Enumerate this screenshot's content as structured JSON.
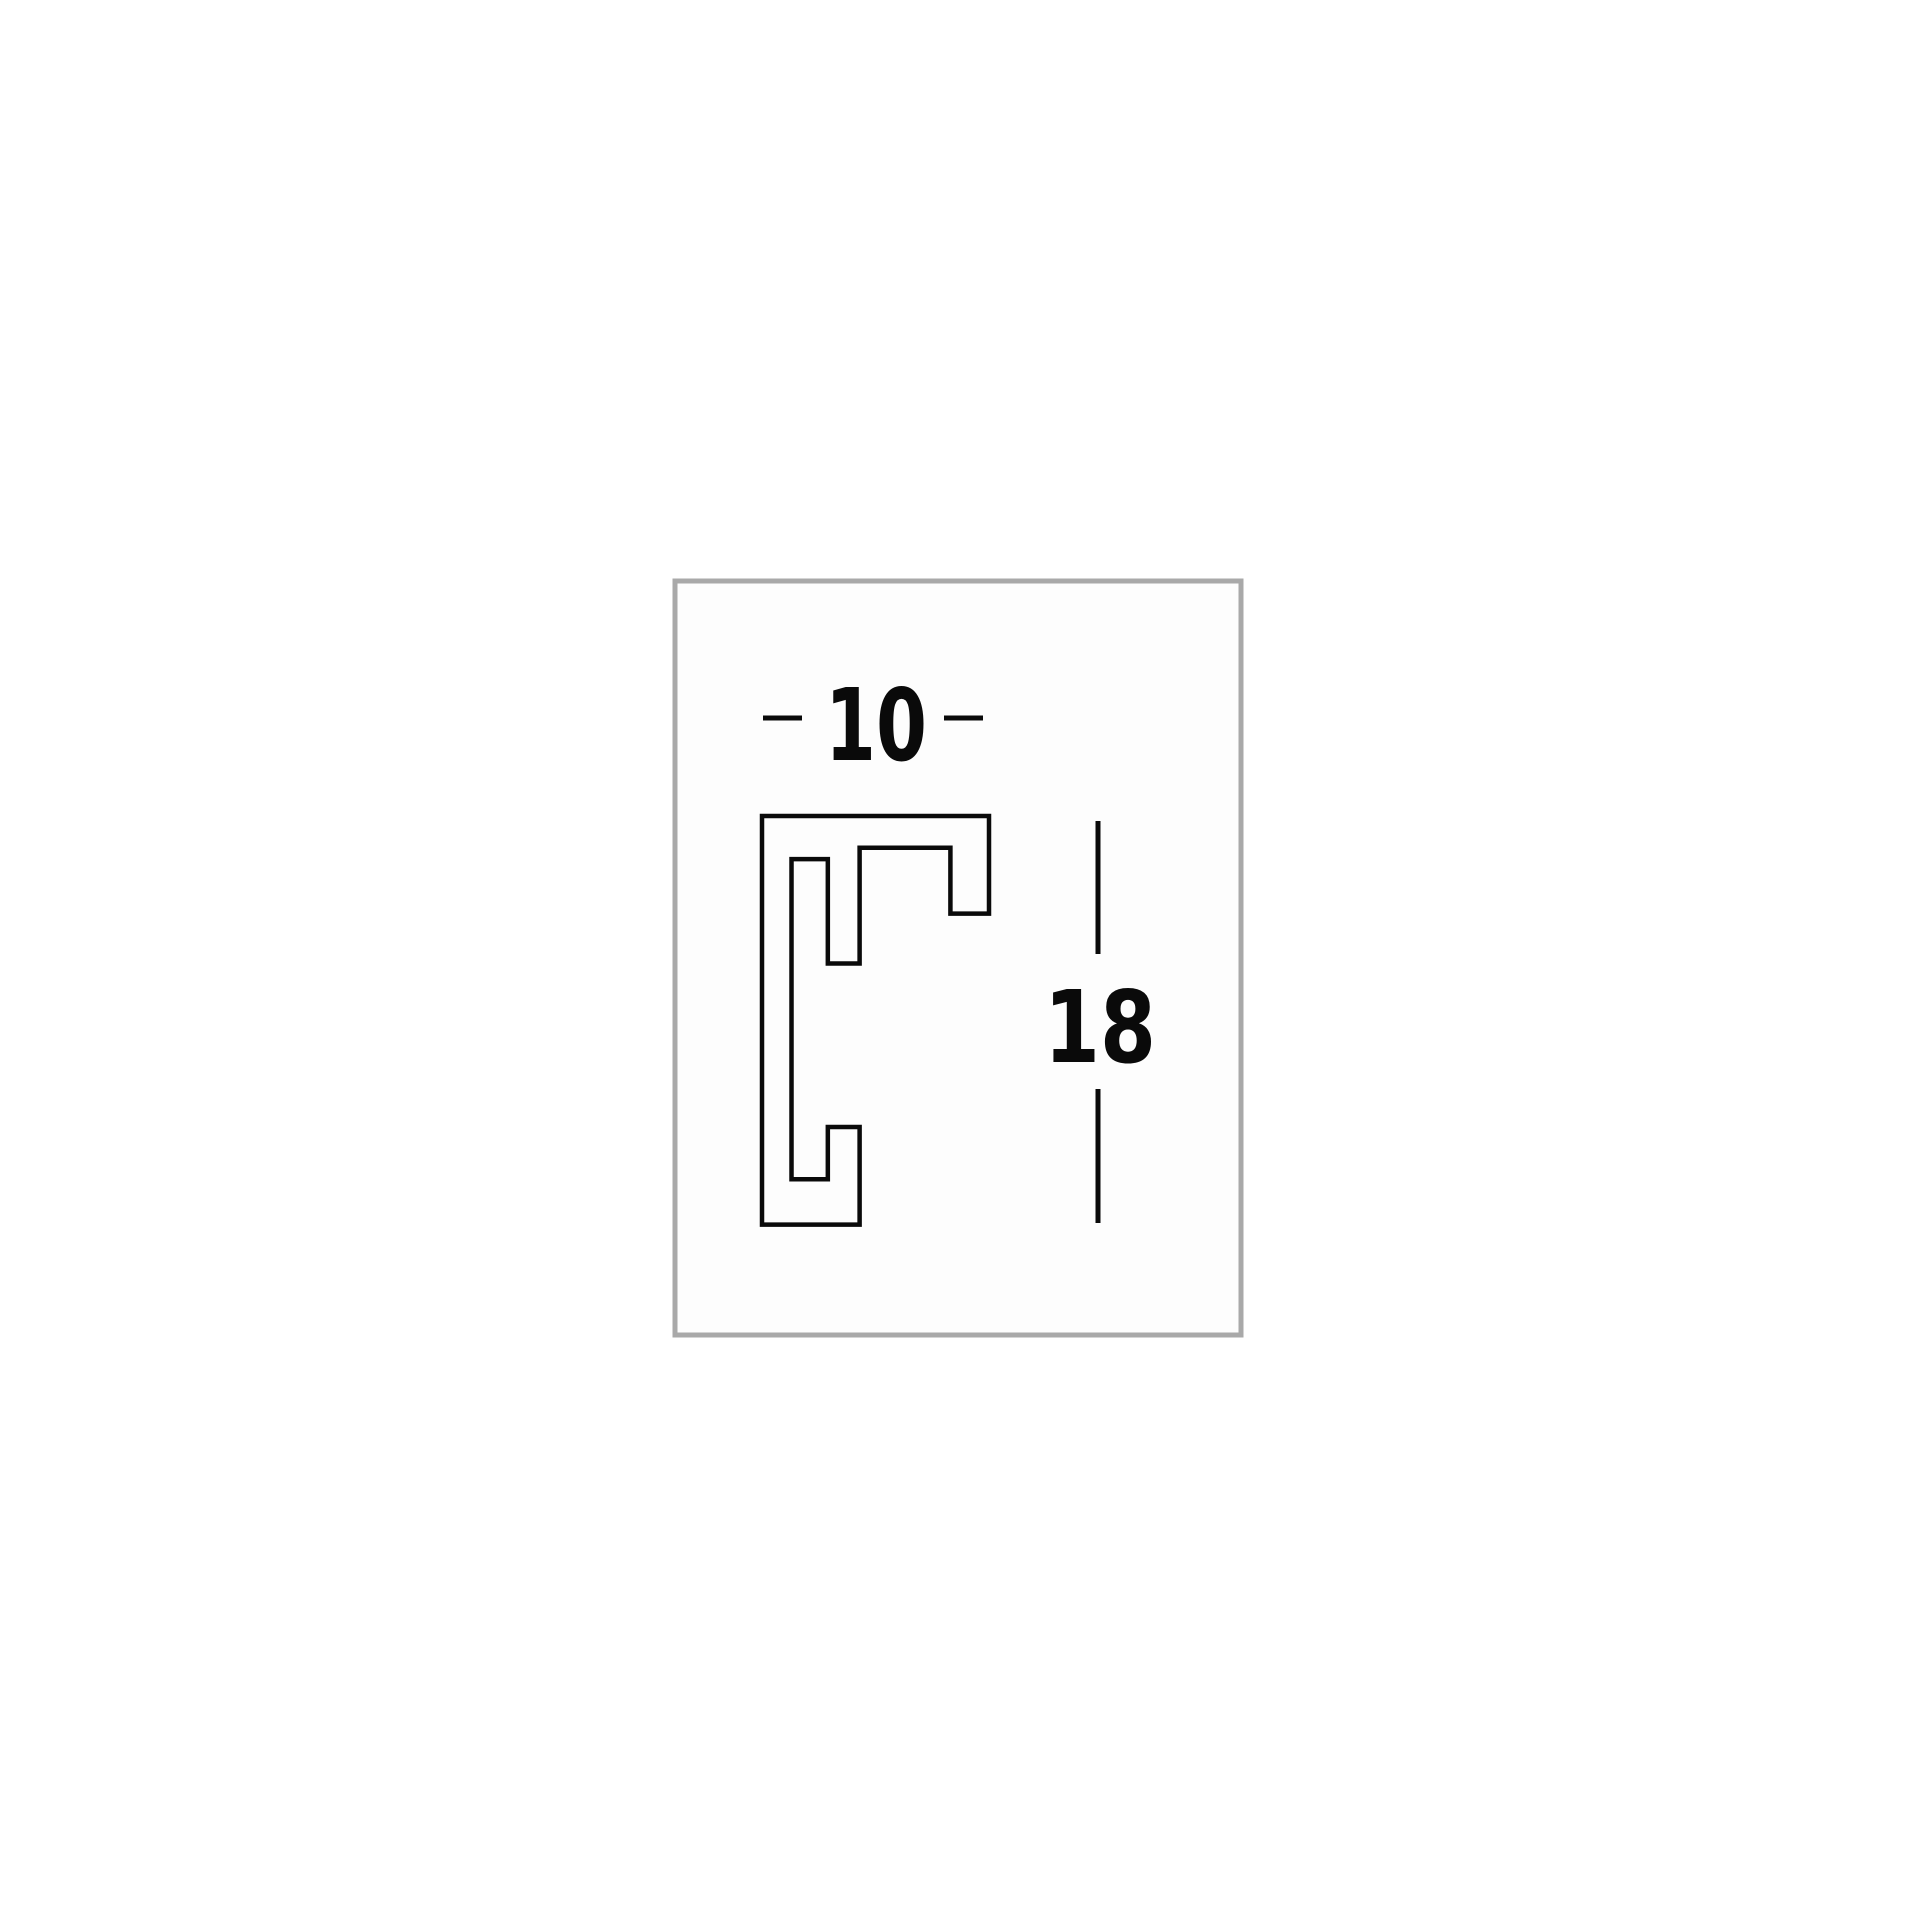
{
  "page": {
    "background": "#ffffff"
  },
  "drawing_box": {
    "border_color": "#a9a9a9",
    "background": "#fdfdfd"
  },
  "diagram": {
    "type": "frame-moulding-profile-cross-section",
    "line_color": "#0a0a0a",
    "width_dimension": {
      "label": "10"
    },
    "height_dimension": {
      "label": "18"
    },
    "profile": {
      "width": 10,
      "height": 18,
      "outline": [
        [
          0,
          0
        ],
        [
          10,
          0
        ],
        [
          10,
          4.3
        ],
        [
          8.3,
          4.3
        ],
        [
          8.3,
          1.4
        ],
        [
          4.3,
          1.4
        ],
        [
          4.3,
          6.5
        ],
        [
          2.9,
          6.5
        ],
        [
          2.9,
          1.9
        ],
        [
          1.3,
          1.9
        ],
        [
          1.3,
          16.0
        ],
        [
          2.9,
          16.0
        ],
        [
          2.9,
          13.7
        ],
        [
          4.3,
          13.7
        ],
        [
          4.3,
          18
        ],
        [
          0,
          18
        ]
      ]
    }
  }
}
